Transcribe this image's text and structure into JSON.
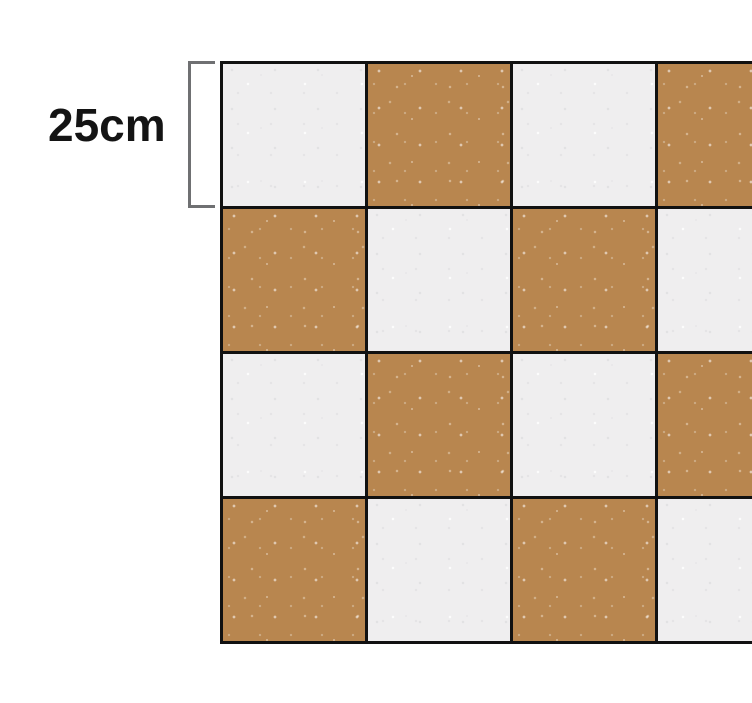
{
  "diagram": {
    "dimension_label": "25cm",
    "grid": {
      "rows": 4,
      "cols": 4,
      "pattern": [
        [
          "light",
          "tan",
          "light",
          "tan"
        ],
        [
          "tan",
          "light",
          "tan",
          "light"
        ],
        [
          "light",
          "tan",
          "light",
          "tan"
        ],
        [
          "tan",
          "light",
          "tan",
          "light"
        ]
      ]
    },
    "colors": {
      "background": "#ffffff",
      "tan_tile": "#b8864f",
      "light_tile": "#efeeef",
      "grid_line": "#111111",
      "bracket": "#6f7072",
      "label_text": "#141414"
    }
  }
}
